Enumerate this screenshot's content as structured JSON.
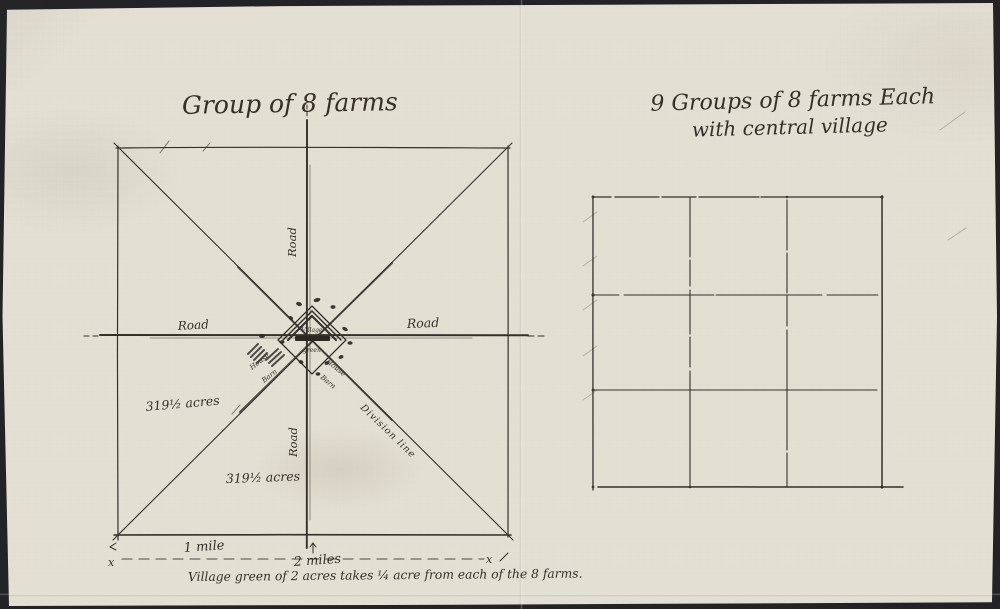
{
  "photo": {
    "background_color": "#232226",
    "paper_color": "#e3dfd3",
    "ink_color": "#35302a"
  },
  "left_diagram": {
    "title": "Group of 8 farms",
    "roads": {
      "left": "Road",
      "right": "Road",
      "top": "Road",
      "bottom": "Road"
    },
    "acres_upper": "319½ acres",
    "acres_lower": "319½ acres",
    "village": {
      "line1": "Village",
      "line2": "green"
    },
    "buildings": {
      "house_sw": "House",
      "barn_sw": "Barn",
      "house_se": "House",
      "barn_se": "Barn"
    },
    "division_line": "Division line",
    "scale": {
      "one_mile": "1 mile",
      "two_miles": "2 miles",
      "marker_left": "x",
      "marker_right": "x"
    },
    "caption": "Village green of 2 acres takes ¼ acre from each of the 8 farms."
  },
  "right_diagram": {
    "title_line1": "9 Groups of 8 farms Each",
    "title_line2": "with central village",
    "grid": {
      "rows": 3,
      "cols": 3
    }
  }
}
